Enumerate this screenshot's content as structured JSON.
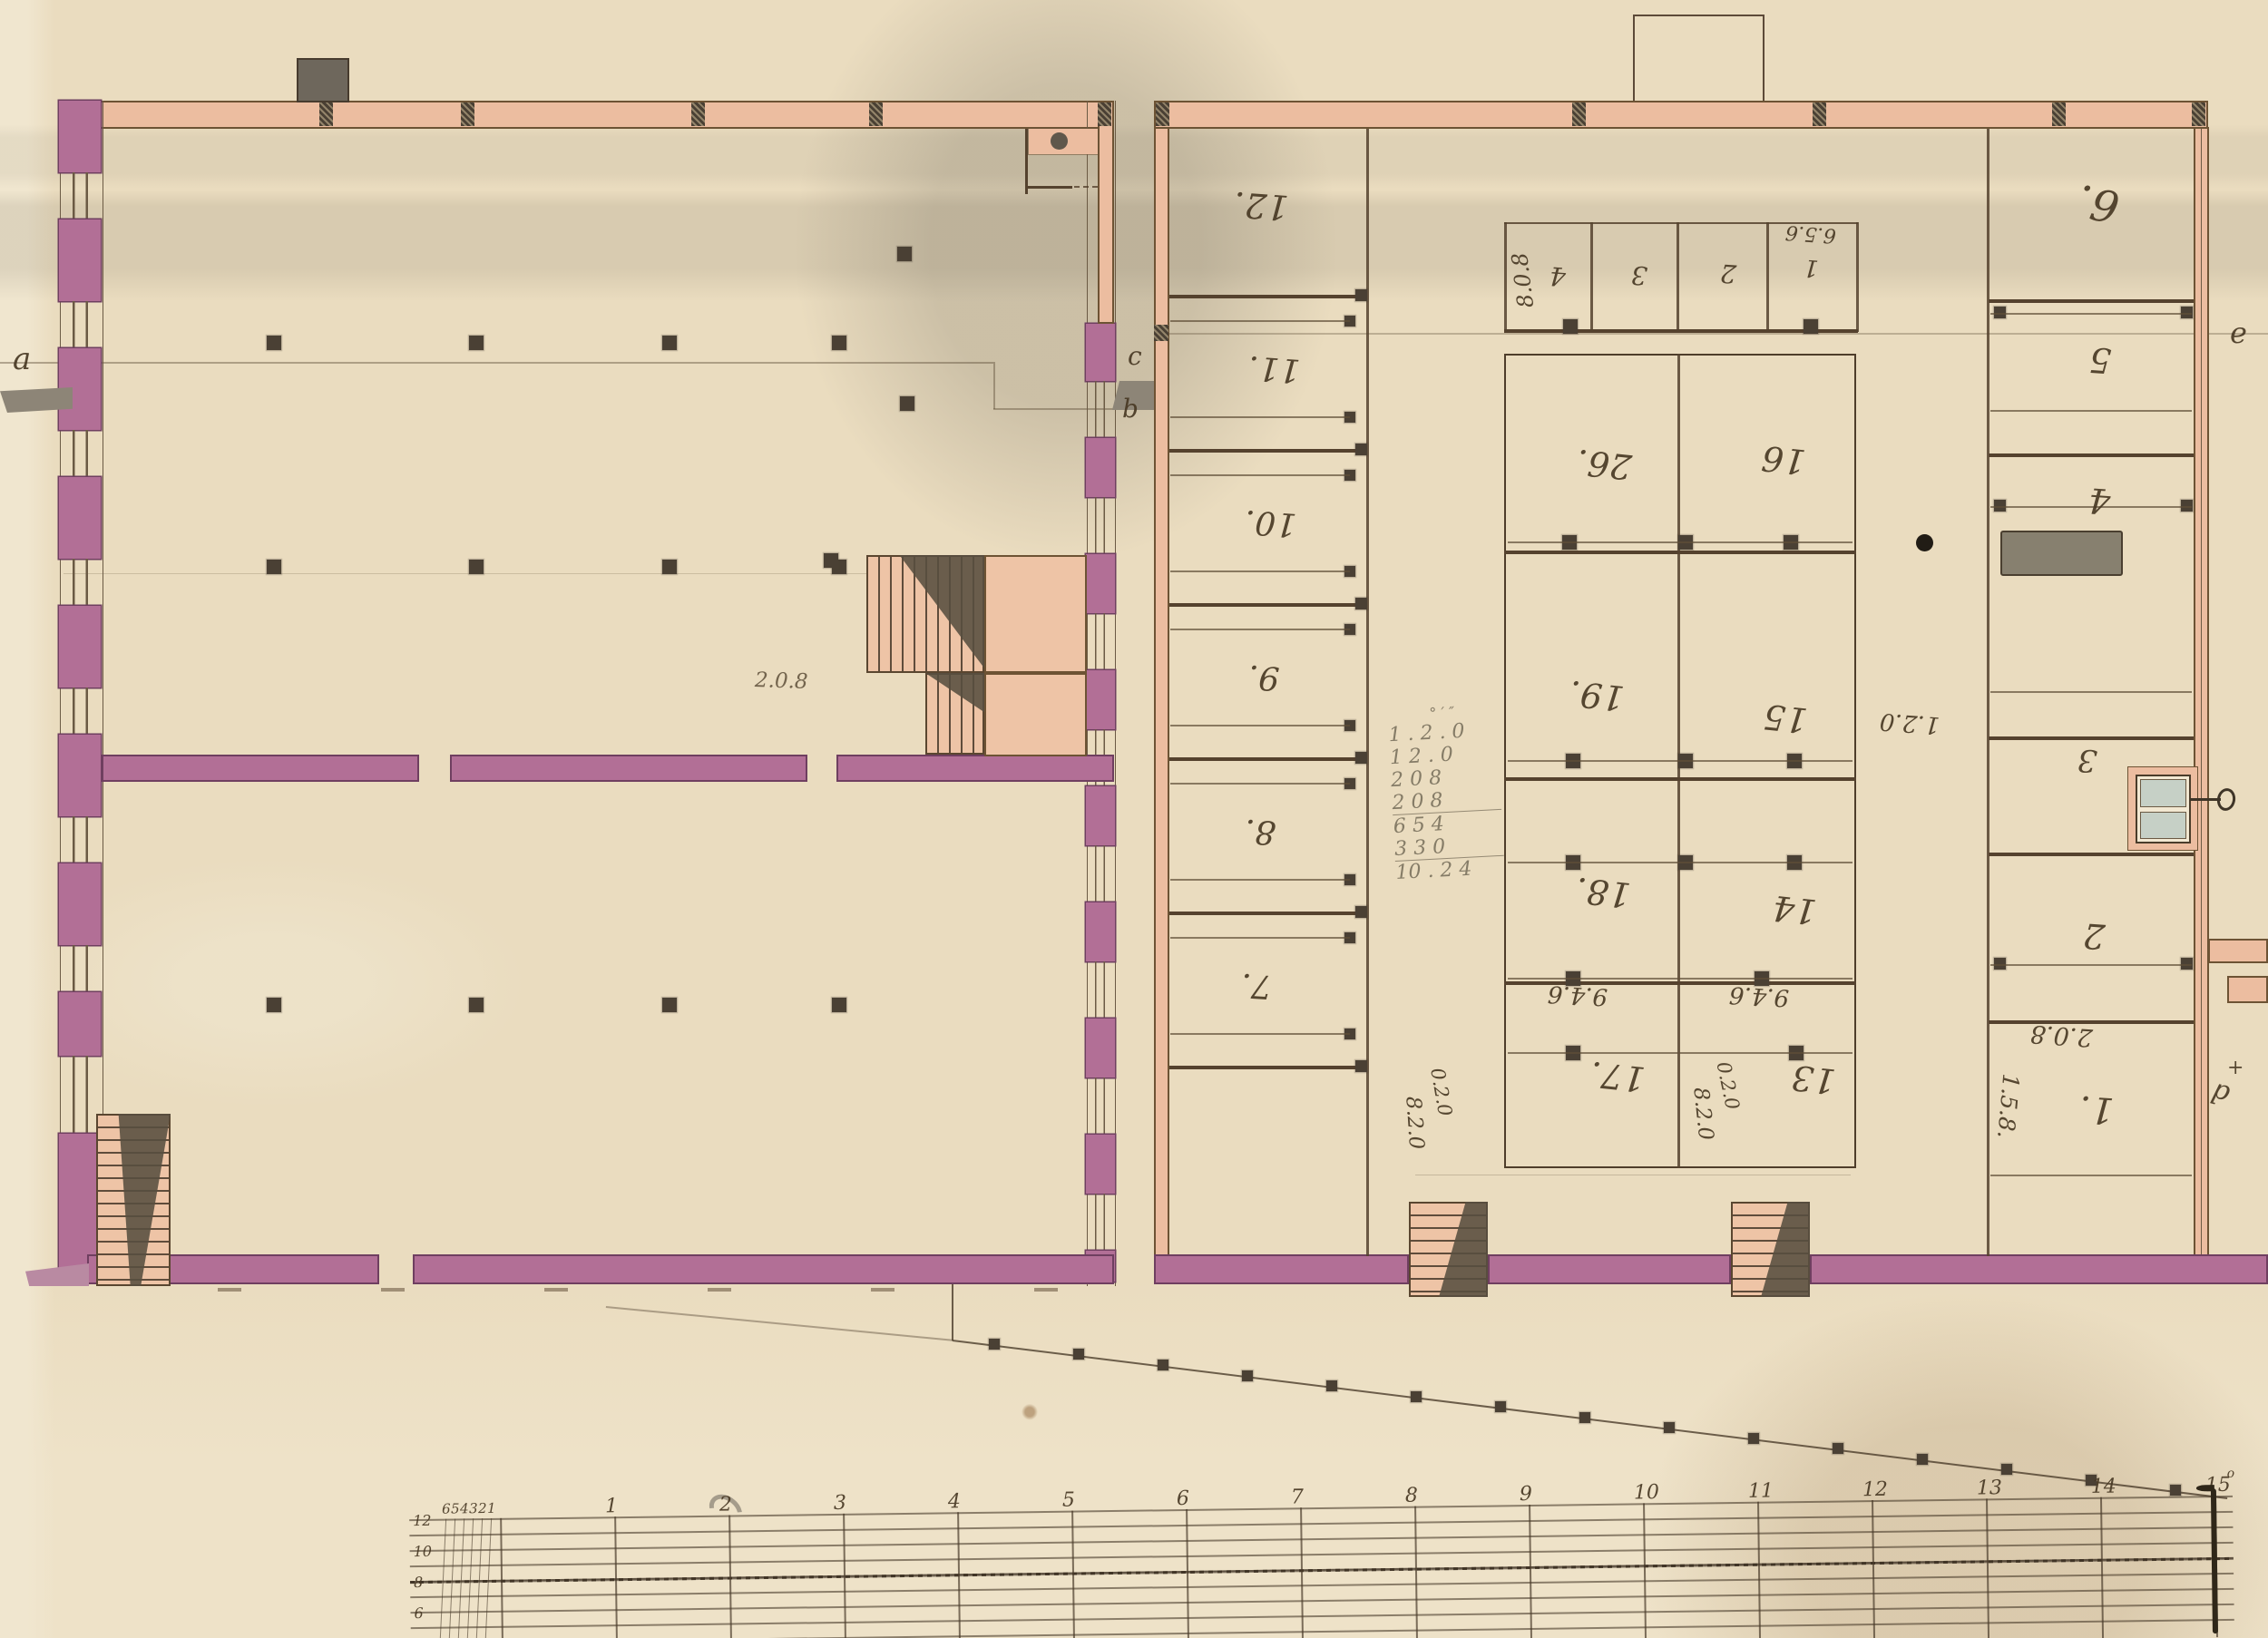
{
  "drawing": {
    "letters": {
      "a": "a",
      "b": "b",
      "c": "c",
      "d": "d",
      "e": "e",
      "plus": "+"
    },
    "rooms": {
      "left": [
        "12.",
        "11.",
        "10.",
        "9.",
        "8.",
        "7."
      ],
      "small_top": [
        "4",
        "3",
        "2",
        "1"
      ],
      "central_left": [
        "26.",
        "19.",
        "18.",
        "17."
      ],
      "central_right": [
        "16",
        "15",
        "14",
        "13"
      ],
      "right": [
        "6.",
        "5",
        "4",
        "3",
        "2",
        "1."
      ]
    },
    "dims": {
      "small_room_height": "8.0.8",
      "small_room_width": "6.5.6",
      "hall_width": "1.2.0",
      "row_left": "9.4.6",
      "row_right": "9.4.6",
      "bl_a": "8.2.0",
      "bl_b": "0.2.0",
      "bm_a": "8.2.0",
      "bm_b": "0.2.0",
      "rc_width": "2.0.8",
      "rc_height": "1.5.8.",
      "lb_dim": "2.0.8"
    },
    "calc": {
      "header": "°  ′  ″",
      "rows": [
        "1 . 2 . 0",
        "1   2 . 0",
        "2   0   8",
        "2   0   8"
      ],
      "sub": [
        "6   5   4",
        "3   3   0"
      ],
      "total": "10 . 2   4"
    },
    "scale": {
      "majors": [
        "1",
        "2",
        "3",
        "4",
        "5",
        "6",
        "7",
        "8",
        "9",
        "10",
        "11",
        "12",
        "13",
        "14",
        "15"
      ],
      "minors": [
        "6",
        "5",
        "4",
        "3",
        "2",
        "1"
      ],
      "rows": [
        "12",
        "10",
        "8",
        "6",
        "4"
      ],
      "degree": "o"
    }
  },
  "colors": {
    "paper": "#eadcbf",
    "wall_pink": "#ecbda0",
    "wall_maroon": "#b26f96",
    "ink": "#4a3a28",
    "pencil": "#8d8370",
    "post": "#4a4034",
    "stove": "#87806f",
    "door_panel": "#c6d0c6",
    "stair": "#eec4a6",
    "shadow": "#5f574a"
  }
}
